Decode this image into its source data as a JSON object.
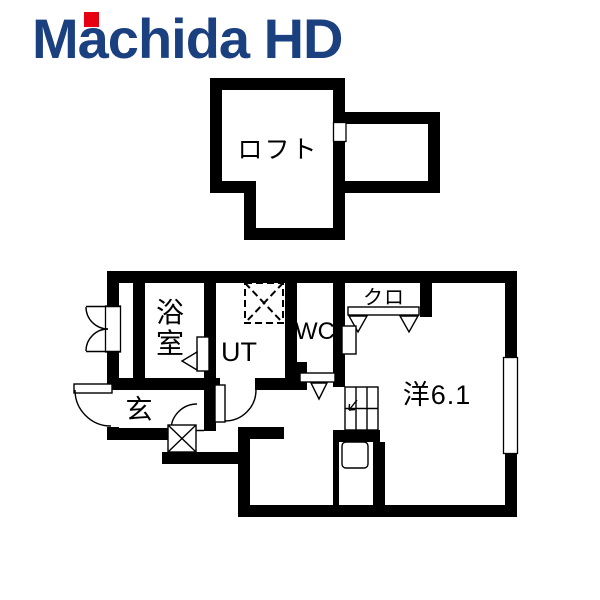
{
  "logo": {
    "wordmark": "Machida HD",
    "navy": "#1a4080",
    "red": "#e60012"
  },
  "floorplan": {
    "background": "#ffffff",
    "wall_color": "#000000",
    "labels": {
      "loft": "ロフト",
      "bath": "浴室",
      "bath_chars": [
        "浴",
        "室"
      ],
      "utility": "UT",
      "toilet": "WC",
      "closet": "クロ",
      "entrance": "玄",
      "main_room": "洋6.1"
    }
  }
}
